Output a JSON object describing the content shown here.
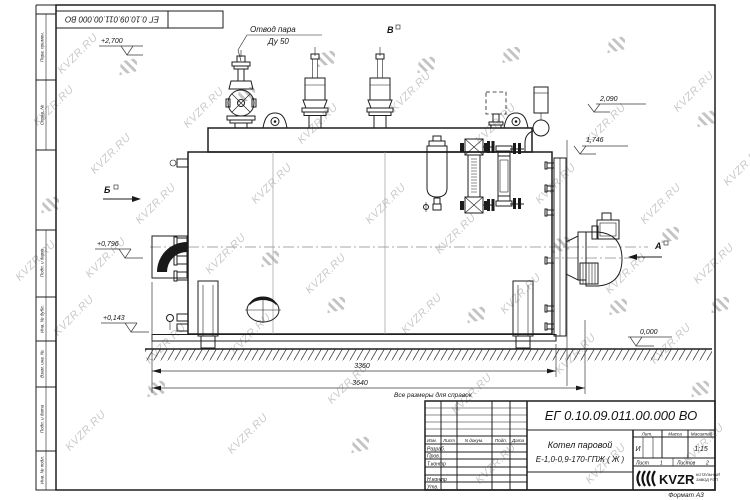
{
  "watermark": {
    "text": "KVZR.RU",
    "color": "#bdbdbd",
    "items": [
      {
        "x": 28,
        "y": 100,
        "t": "text"
      },
      {
        "x": 10,
        "y": 255,
        "t": "text"
      },
      {
        "x": 48,
        "y": 310,
        "t": "text"
      },
      {
        "x": 85,
        "y": 148,
        "t": "text"
      },
      {
        "x": 80,
        "y": 252,
        "t": "text"
      },
      {
        "x": 60,
        "y": 425,
        "t": "text"
      },
      {
        "x": 130,
        "y": 198,
        "t": "text"
      },
      {
        "x": 140,
        "y": 338,
        "t": "text"
      },
      {
        "x": 178,
        "y": 102,
        "t": "text"
      },
      {
        "x": 200,
        "y": 248,
        "t": "text"
      },
      {
        "x": 225,
        "y": 328,
        "t": "text"
      },
      {
        "x": 246,
        "y": 178,
        "t": "text"
      },
      {
        "x": 292,
        "y": 118,
        "t": "text"
      },
      {
        "x": 300,
        "y": 268,
        "t": "text"
      },
      {
        "x": 322,
        "y": 378,
        "t": "text"
      },
      {
        "x": 360,
        "y": 198,
        "t": "text"
      },
      {
        "x": 385,
        "y": 86,
        "t": "text"
      },
      {
        "x": 396,
        "y": 308,
        "t": "text"
      },
      {
        "x": 430,
        "y": 228,
        "t": "text"
      },
      {
        "x": 446,
        "y": 388,
        "t": "text"
      },
      {
        "x": 470,
        "y": 118,
        "t": "text"
      },
      {
        "x": 495,
        "y": 288,
        "t": "text"
      },
      {
        "x": 530,
        "y": 178,
        "t": "text"
      },
      {
        "x": 550,
        "y": 348,
        "t": "text"
      },
      {
        "x": 580,
        "y": 118,
        "t": "text"
      },
      {
        "x": 600,
        "y": 268,
        "t": "text"
      },
      {
        "x": 635,
        "y": 198,
        "t": "text"
      },
      {
        "x": 645,
        "y": 338,
        "t": "text"
      },
      {
        "x": 668,
        "y": 86,
        "t": "text"
      },
      {
        "x": 688,
        "y": 258,
        "t": "text"
      },
      {
        "x": 678,
        "y": 438,
        "t": "text"
      },
      {
        "x": 580,
        "y": 458,
        "t": "text"
      },
      {
        "x": 470,
        "y": 458,
        "t": "text"
      },
      {
        "x": 222,
        "y": 428,
        "t": "text"
      },
      {
        "x": 52,
        "y": 48,
        "t": "text"
      },
      {
        "x": 718,
        "y": 160,
        "t": "text"
      },
      {
        "x": 120,
        "y": 60,
        "t": "logo"
      },
      {
        "x": 238,
        "y": 88,
        "t": "logo"
      },
      {
        "x": 318,
        "y": 52,
        "t": "logo"
      },
      {
        "x": 418,
        "y": 58,
        "t": "logo"
      },
      {
        "x": 503,
        "y": 48,
        "t": "logo"
      },
      {
        "x": 608,
        "y": 38,
        "t": "logo"
      },
      {
        "x": 698,
        "y": 112,
        "t": "logo"
      },
      {
        "x": 662,
        "y": 228,
        "t": "logo"
      },
      {
        "x": 692,
        "y": 382,
        "t": "logo"
      },
      {
        "x": 553,
        "y": 238,
        "t": "logo"
      },
      {
        "x": 468,
        "y": 308,
        "t": "logo"
      },
      {
        "x": 328,
        "y": 298,
        "t": "logo"
      },
      {
        "x": 148,
        "y": 382,
        "t": "logo"
      },
      {
        "x": 42,
        "y": 198,
        "t": "logo"
      },
      {
        "x": 262,
        "y": 252,
        "t": "logo"
      },
      {
        "x": 712,
        "y": 298,
        "t": "logo"
      },
      {
        "x": 352,
        "y": 438,
        "t": "logo"
      },
      {
        "x": 610,
        "y": 300,
        "t": "logo"
      }
    ]
  },
  "frame": {
    "left_labels": [
      "Перв. примен.",
      "Справ. №",
      "Подп. и дата",
      "Инв. № дубл.",
      "Взам. инв. №",
      "Подп. и дата",
      "Инв. № подл."
    ]
  },
  "stamp_top": {
    "doc_number": "ЕГ 0.10.09.011.00.000  ВО"
  },
  "annotations": {
    "steam_outlet_line1": "Отвод пара",
    "steam_outlet_line2": "Ду 50",
    "view_b": "Б",
    "view_v": "В",
    "view_a": "А",
    "elev_2700": "+2,700",
    "elev_2090": "2,090",
    "elev_1746": "1,746",
    "elev_0796": "+0,796",
    "elev_0143": "+0,143",
    "elev_0000": "0,000",
    "dim_3360": "3360",
    "dim_3640": "3640",
    "note": "Все размеры для справок"
  },
  "title_block": {
    "doc_number": "ЕГ 0.10.09.011.00.000  ВО",
    "name_line1": "Котел паровой",
    "name_line2": "Е-1,0-0,9-170-ГПЖ ( Ж )",
    "col_izm": "Изм.",
    "col_list": "Лист",
    "col_ndoc": "N докум.",
    "col_podp": "Подп.",
    "col_data": "Дата",
    "row_razrab": "Разраб.",
    "row_prov": "Пров.",
    "row_tkontr": "Т.контр",
    "row_nkontr": "Н.контр",
    "row_utv": "Утв.",
    "lit_header": "Лит.",
    "mass_header": "Масса",
    "scale_header": "Масштаб",
    "lit_value": "И",
    "scale_value": "1:15",
    "sheet_label": "Лист",
    "sheet_value": "1",
    "sheets_label": "Листов",
    "sheets_value": "2",
    "logo_text": "KVZR",
    "company_line1": "КОТЕЛЬНЫЙ",
    "company_line2": "ЗАВОД РЭП",
    "format": "Формат  А3"
  }
}
